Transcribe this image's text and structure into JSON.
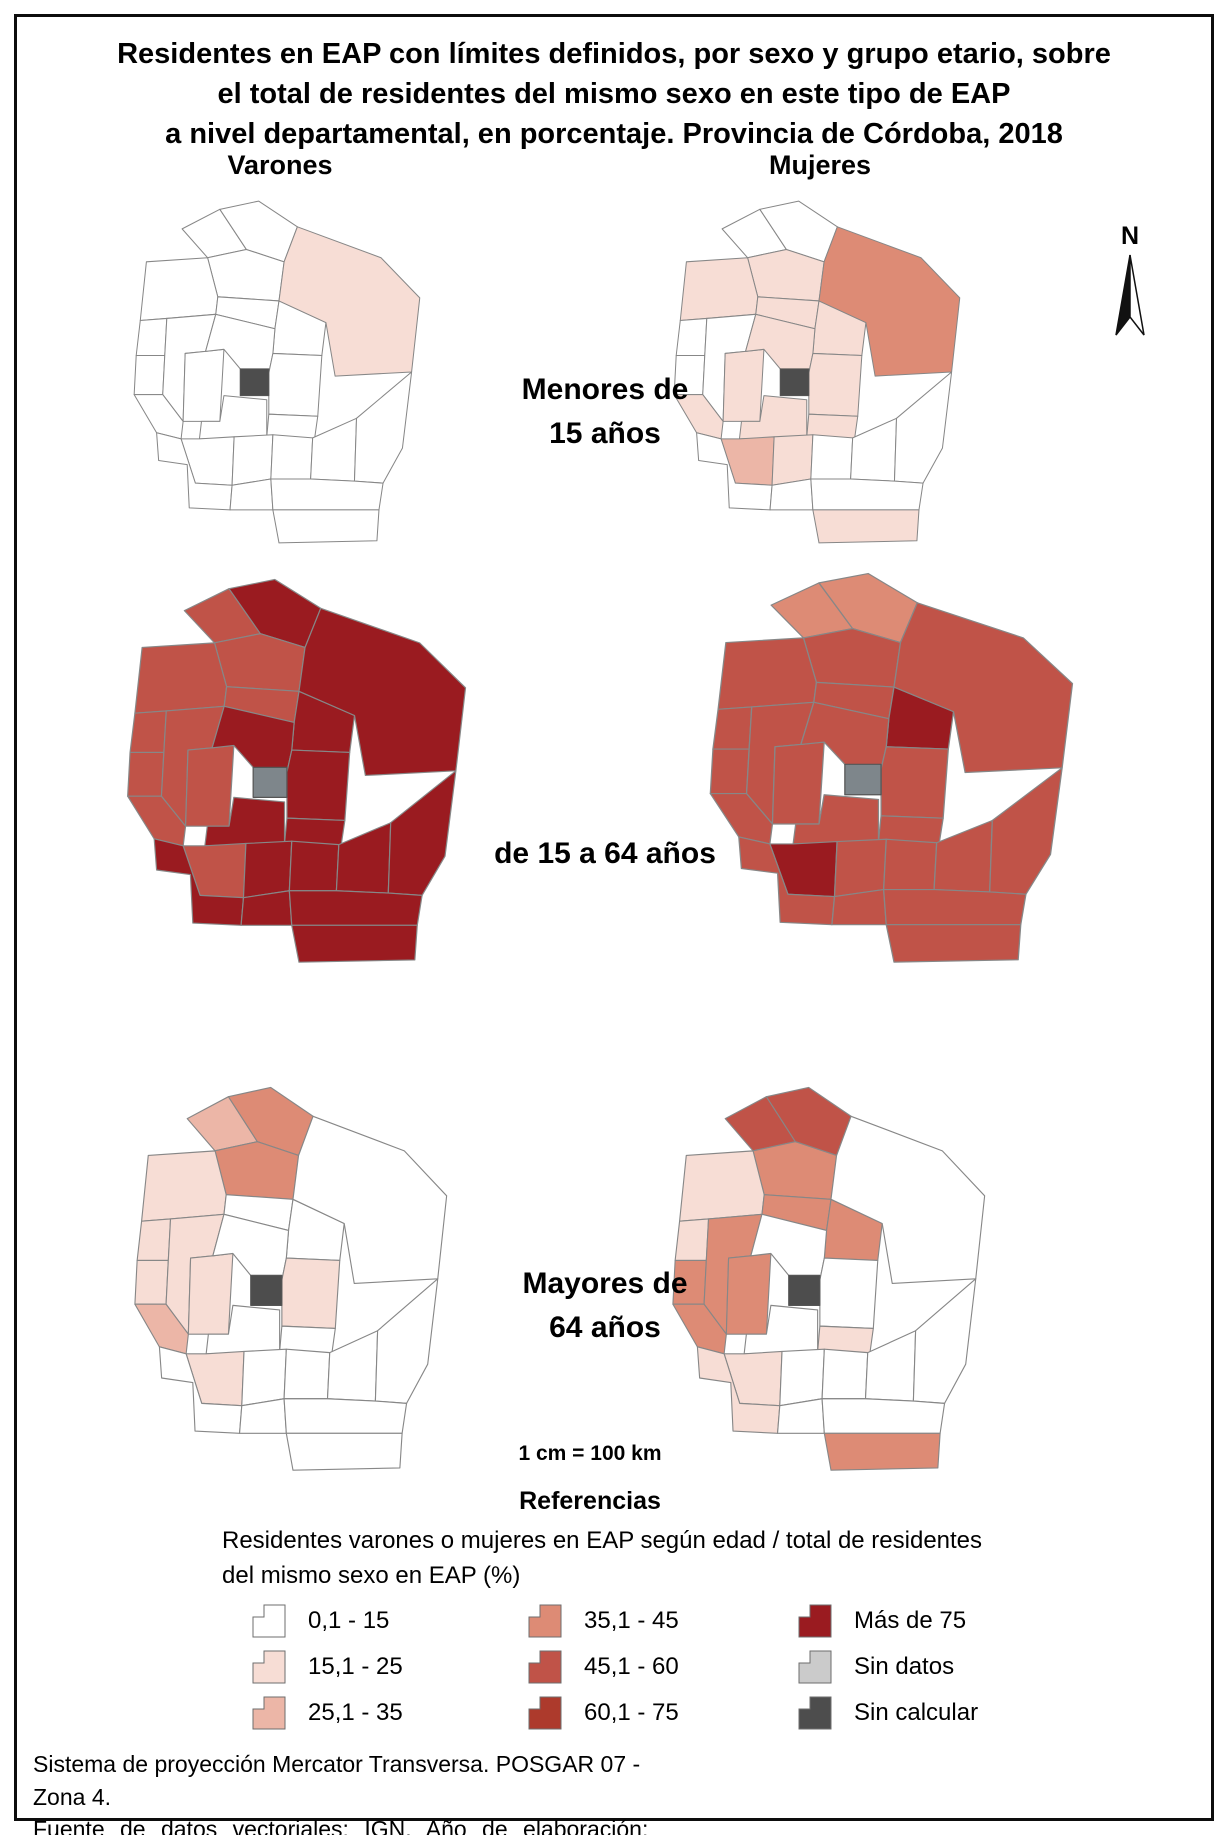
{
  "title": {
    "line1": "Residentes en EAP con límites definidos, por sexo y grupo etario, sobre",
    "line2": "el total de residentes del mismo sexo en este tipo de EAP",
    "line3": "a nivel departamental, en porcentaje. Provincia de Córdoba, 2018"
  },
  "north_label": "N",
  "columns": {
    "left": "Varones",
    "right": "Mujeres"
  },
  "rows": [
    {
      "line1": "Menores de",
      "line2": "15 años"
    },
    {
      "line1": "de 15 a 64 años",
      "line2": ""
    },
    {
      "line1": "Mayores de",
      "line2": "64 años"
    }
  ],
  "scale_text": "1 cm = 100 km",
  "legend": {
    "heading": "Referencias",
    "description_line1": "Residentes varones o mujeres en EAP según edad / total de residentes",
    "description_line2": "del mismo sexo en EAP (%)",
    "columns": [
      [
        {
          "label": "0,1 - 15",
          "class": "c0"
        },
        {
          "label": "15,1 - 25",
          "class": "c1"
        },
        {
          "label": "25,1 - 35",
          "class": "c2"
        }
      ],
      [
        {
          "label": "35,1 - 45",
          "class": "c3"
        },
        {
          "label": "45,1 - 60",
          "class": "c4"
        },
        {
          "label": "60,1 - 75",
          "class": "c5"
        }
      ],
      [
        {
          "label": "Más de 75",
          "class": "c6"
        },
        {
          "label": "Sin datos",
          "class": "sd"
        },
        {
          "label": "Sin calcular",
          "class": "sc"
        }
      ]
    ]
  },
  "class_colors": {
    "c0": "#ffffff",
    "c1": "#f7ddd5",
    "c2": "#ecb6a7",
    "c3": "#dd8b75",
    "c4": "#c05348",
    "c5": "#ad3a2c",
    "c6": "#9a1b20",
    "sd": "#cbcbcb",
    "sc": "#4d4d4d",
    "sdm": "#7e868b"
  },
  "footer": {
    "line1": "Sistema de proyección Mercator Transversa. POSGAR 07 - Zona 4.",
    "line2": "Fuente de datos vectoriales: IGN. Año de elaboración: 2023."
  },
  "maps": [
    {
      "id": "v1",
      "sex": "Varones",
      "age_group": "Menores de 15 años",
      "dept_classes": {
        "sobremonte": "c0",
        "rio_seco": "c0",
        "tulumba": "c0",
        "cruz_del_eje": "c0",
        "ischilin": "c0",
        "totoral": "c0",
        "san_justo": "c1",
        "minas": "c0",
        "pocho": "c0",
        "san_alberto": "c0",
        "punilla": "c0",
        "colon": "c0",
        "rio_primero": "c0",
        "santa_maria": "c0",
        "rio_segundo": "c0",
        "san_javier": "c0",
        "calamuchita": "c0",
        "tercero_arriba": "c0",
        "general_san_martin": "c0",
        "union": "c0",
        "marcos_juarez": "c0",
        "rio_cuarto": "c0",
        "juarez_celman": "c0",
        "pres_saenz_pena": "c0",
        "general_roca": "c0",
        "capital": "sc"
      }
    },
    {
      "id": "m1",
      "sex": "Mujeres",
      "age_group": "Menores de 15 años",
      "dept_classes": {
        "sobremonte": "c0",
        "rio_seco": "c0",
        "tulumba": "c1",
        "cruz_del_eje": "c1",
        "ischilin": "c1",
        "totoral": "c1",
        "san_justo": "c3",
        "minas": "c0",
        "pocho": "c0",
        "san_alberto": "c0",
        "punilla": "c1",
        "colon": "c1",
        "rio_primero": "c1",
        "santa_maria": "c1",
        "rio_segundo": "c1",
        "san_javier": "c1",
        "calamuchita": "c2",
        "tercero_arriba": "c1",
        "general_san_martin": "c0",
        "union": "c0",
        "marcos_juarez": "c0",
        "rio_cuarto": "c0",
        "juarez_celman": "c0",
        "pres_saenz_pena": "c0",
        "general_roca": "c1",
        "capital": "sc"
      }
    },
    {
      "id": "v2",
      "sex": "Varones",
      "age_group": "de 15 a 64 años",
      "dept_classes": {
        "sobremonte": "c4",
        "rio_seco": "c6",
        "tulumba": "c4",
        "cruz_del_eje": "c4",
        "ischilin": "c4",
        "totoral": "c6",
        "san_justo": "c6",
        "minas": "c4",
        "pocho": "c4",
        "san_alberto": "c4",
        "punilla": "c4",
        "colon": "c6",
        "rio_primero": "c6",
        "santa_maria": "c6",
        "rio_segundo": "c6",
        "san_javier": "c4",
        "calamuchita": "c4",
        "tercero_arriba": "c6",
        "general_san_martin": "c6",
        "union": "c6",
        "marcos_juarez": "c6",
        "rio_cuarto": "c6",
        "juarez_celman": "c6",
        "pres_saenz_pena": "c6",
        "general_roca": "c6",
        "capital": "sdm"
      }
    },
    {
      "id": "m2",
      "sex": "Mujeres",
      "age_group": "de 15 a 64 años",
      "dept_classes": {
        "sobremonte": "c3",
        "rio_seco": "c3",
        "tulumba": "c4",
        "cruz_del_eje": "c4",
        "ischilin": "c4",
        "totoral": "c6",
        "san_justo": "c4",
        "minas": "c4",
        "pocho": "c4",
        "san_alberto": "c4",
        "punilla": "c4",
        "colon": "c4",
        "rio_primero": "c4",
        "santa_maria": "c4",
        "rio_segundo": "c4",
        "san_javier": "c4",
        "calamuchita": "c6",
        "tercero_arriba": "c4",
        "general_san_martin": "c4",
        "union": "c4",
        "marcos_juarez": "c4",
        "rio_cuarto": "c4",
        "juarez_celman": "c4",
        "pres_saenz_pena": "c4",
        "general_roca": "c4",
        "capital": "sdm"
      }
    },
    {
      "id": "v3",
      "sex": "Varones",
      "age_group": "Mayores de 64 años",
      "dept_classes": {
        "sobremonte": "c2",
        "rio_seco": "c3",
        "tulumba": "c3",
        "cruz_del_eje": "c1",
        "ischilin": "c0",
        "totoral": "c0",
        "san_justo": "c0",
        "minas": "c1",
        "pocho": "c1",
        "san_alberto": "c1",
        "punilla": "c1",
        "colon": "c0",
        "rio_primero": "c1",
        "santa_maria": "c0",
        "rio_segundo": "c0",
        "san_javier": "c2",
        "calamuchita": "c1",
        "tercero_arriba": "c0",
        "general_san_martin": "c0",
        "union": "c0",
        "marcos_juarez": "c0",
        "rio_cuarto": "c0",
        "juarez_celman": "c0",
        "pres_saenz_pena": "c0",
        "general_roca": "c0",
        "capital": "sc"
      }
    },
    {
      "id": "m3",
      "sex": "Mujeres",
      "age_group": "Mayores de 64 años",
      "dept_classes": {
        "sobremonte": "c4",
        "rio_seco": "c4",
        "tulumba": "c3",
        "cruz_del_eje": "c1",
        "ischilin": "c3",
        "totoral": "c3",
        "san_justo": "c0",
        "minas": "c1",
        "pocho": "c3",
        "san_alberto": "c3",
        "punilla": "c3",
        "colon": "c0",
        "rio_primero": "c0",
        "santa_maria": "c0",
        "rio_segundo": "c1",
        "san_javier": "c3",
        "calamuchita": "c1",
        "tercero_arriba": "c0",
        "general_san_martin": "c0",
        "union": "c0",
        "marcos_juarez": "c0",
        "rio_cuarto": "c1",
        "juarez_celman": "c0",
        "pres_saenz_pena": "c0",
        "general_roca": "c3",
        "capital": "sc"
      }
    }
  ]
}
